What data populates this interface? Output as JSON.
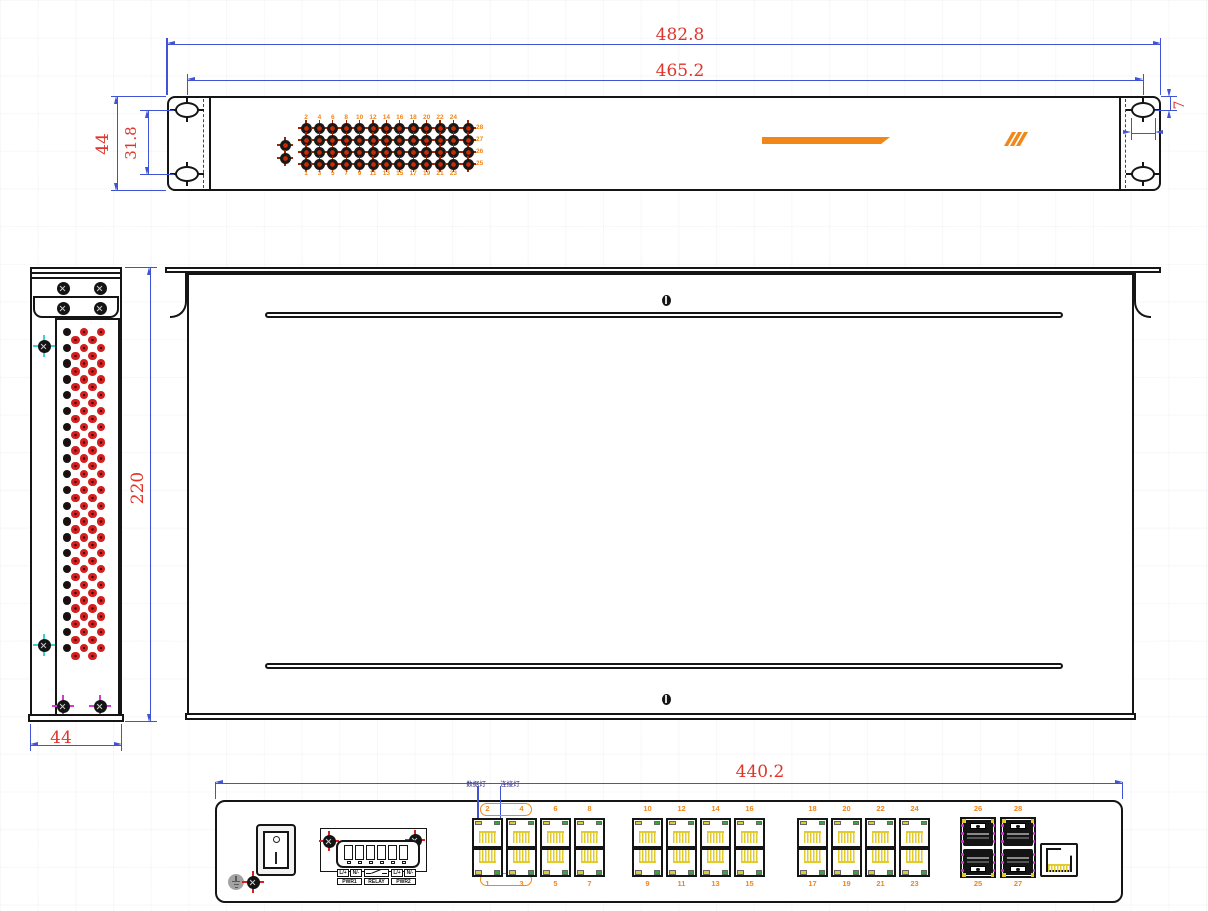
{
  "front_view": {
    "dim_overall_width": "482.8",
    "dim_hole_center_width": "465.2",
    "dim_height": "44",
    "dim_hole_spacing_vertical": "31.8",
    "dim_hole_offset_top": "7",
    "dim_hole_width": "11",
    "led_panel": {
      "pwr_label": "PWR",
      "run_label": "RUN",
      "top_numbers": [
        "2",
        "4",
        "6",
        "8",
        "10",
        "12",
        "14",
        "16",
        "18",
        "20",
        "22",
        "24"
      ],
      "bottom_numbers": [
        "1",
        "3",
        "5",
        "7",
        "9",
        "11",
        "13",
        "15",
        "17",
        "19",
        "21",
        "23"
      ],
      "right_numbers": [
        "28",
        "27",
        "26",
        "25"
      ]
    },
    "branding": {
      "series_label": "RACK-MOUNTED SERIES",
      "slashes": "///",
      "title": "INDUSTRIAL ETHERNET SWITCHES"
    }
  },
  "side_view": {
    "dim_depth": "220",
    "dim_width": "44"
  },
  "rear_view": {
    "dim_width": "440.2",
    "power": {
      "on_label": "ON",
      "off_label": "OFF",
      "input_title": "INPUT POWER",
      "input_range": "AC/DC85~265V",
      "terminal_row1": [
        "L/+",
        "N/-",
        "L/+",
        "N/-"
      ],
      "terminal_row2": [
        "PWR1",
        "RELAY",
        "PWR2"
      ],
      "ac_label": "AC",
      "dc_label": "DC"
    },
    "annotations": {
      "data_led": "数据灯",
      "link_led": "连接灯"
    },
    "bypass_top_label": "By PASS",
    "bypass_bottom_label": "By PASS",
    "port_groups": {
      "top_numbers": [
        [
          "2",
          "4",
          "6",
          "8"
        ],
        [
          "10",
          "12",
          "14",
          "16"
        ],
        [
          "18",
          "20",
          "22",
          "24"
        ]
      ],
      "bottom_numbers": [
        [
          "1",
          "3",
          "5",
          "7"
        ],
        [
          "9",
          "11",
          "13",
          "15"
        ],
        [
          "17",
          "19",
          "21",
          "23"
        ]
      ]
    },
    "sfp": {
      "top_numbers": [
        "26",
        "28"
      ],
      "bottom_numbers": [
        "25",
        "27"
      ]
    },
    "console_label": "CONSOLE"
  },
  "colors": {
    "line": "#151515",
    "dimension_line": "#4053d4",
    "dimension_text": "#e0342b",
    "accent_orange": "#f08718",
    "led_red": "#cc2a00",
    "vent_red": "#d41f1f",
    "pin_yellow": "#e2cb2c",
    "led_green": "#2eae2e",
    "sfp_magenta": "#d23ad2"
  }
}
